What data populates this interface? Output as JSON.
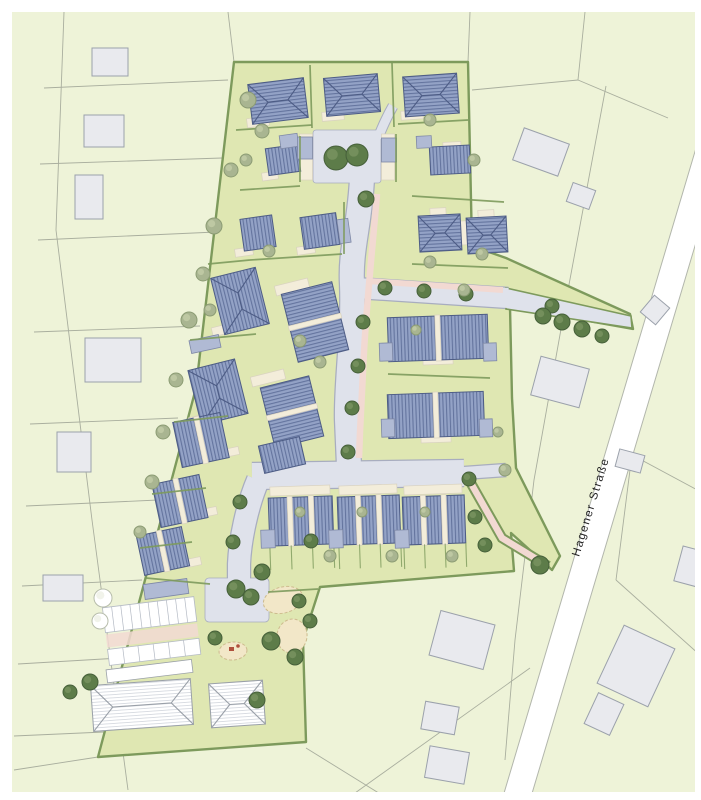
{
  "street_label": "Hagener Straße",
  "palette": {
    "outside": "#eef3d8",
    "parcel": "#a9ae9e",
    "xfill": "#e9eaee",
    "xstroke": "#9ba1ab",
    "site": "#dfe7b2",
    "hedge": "#7d9a5c",
    "road": "#dfe2eb",
    "roadline": "#a8adbf",
    "pink": "#f2d9d2",
    "cream": "#f3edda",
    "creamline": "#d9d2c0",
    "roof": "#93a2c6",
    "roofstripe": "#64749e",
    "roofedge": "#4d5c85",
    "garage": "#b0bad4",
    "sand": "#f2e7c8",
    "equipment": "#b0503c"
  },
  "houses": [
    [
      "hip",
      278,
      101,
      56,
      40,
      -7,
      1
    ],
    [
      "hip",
      352,
      95,
      54,
      38,
      -5,
      1
    ],
    [
      "hip",
      431,
      95,
      54,
      40,
      -4,
      1
    ],
    [
      "gable",
      283,
      160,
      32,
      27,
      -8,
      1
    ],
    [
      "gable",
      258,
      233,
      32,
      32,
      -8,
      1
    ],
    [
      "gable",
      320,
      231,
      36,
      32,
      -8,
      1
    ],
    [
      "hip",
      240,
      301,
      46,
      58,
      -14,
      1
    ],
    [
      "hip",
      218,
      392,
      48,
      56,
      -14,
      1
    ],
    [
      "gable",
      315,
      322,
      52,
      70,
      -14,
      2
    ],
    [
      "gable",
      292,
      412,
      50,
      62,
      -14,
      2
    ],
    [
      "gable",
      282,
      455,
      42,
      28,
      -13,
      1
    ],
    [
      "gable",
      201,
      440,
      48,
      46,
      -12,
      2
    ],
    [
      "gable",
      180,
      501,
      48,
      44,
      -12,
      2
    ],
    [
      "gable",
      163,
      551,
      46,
      40,
      -12,
      2
    ],
    [
      "gable",
      450,
      160,
      40,
      28,
      -3,
      1
    ],
    [
      "hip",
      440,
      233,
      42,
      36,
      -3,
      1
    ],
    [
      "hip",
      487,
      235,
      40,
      36,
      -3,
      1
    ],
    [
      "gable",
      438,
      338,
      100,
      44,
      -2,
      2
    ],
    [
      "gable",
      436,
      415,
      96,
      44,
      -2,
      2
    ],
    [
      "row",
      301,
      521,
      64,
      48,
      -2,
      3
    ],
    [
      "row",
      369,
      520,
      62,
      48,
      -2,
      3
    ],
    [
      "row",
      434,
      520,
      62,
      48,
      -2,
      3
    ],
    [
      "whitehip",
      142,
      705,
      100,
      46,
      -4,
      1
    ],
    [
      "whitehip",
      237,
      704,
      54,
      44,
      -4,
      1
    ]
  ],
  "garages": [
    [
      "garage",
      289,
      141,
      18,
      13,
      -8
    ],
    [
      "garage",
      344,
      231,
      11,
      24,
      -8
    ],
    [
      "garage",
      205,
      344,
      30,
      13,
      -12
    ],
    [
      "garage",
      305,
      148,
      15,
      22,
      0
    ],
    [
      "garage",
      389,
      150,
      15,
      24,
      0
    ],
    [
      "garage",
      424,
      142,
      15,
      12,
      -3
    ],
    [
      "garage",
      386,
      352,
      13,
      18,
      -2
    ],
    [
      "garage",
      490,
      352,
      13,
      18,
      -2
    ],
    [
      "garage",
      388,
      428,
      13,
      18,
      -2
    ],
    [
      "garage",
      486,
      428,
      13,
      18,
      -2
    ],
    [
      "garage",
      268,
      539,
      14,
      18,
      -2
    ],
    [
      "garage",
      336,
      539,
      14,
      18,
      -2
    ],
    [
      "garage",
      402,
      539,
      14,
      18,
      -2
    ],
    [
      "garage",
      166,
      589,
      44,
      15,
      -8
    ]
  ],
  "terraces": [
    [
      258,
      122,
      22,
      9,
      -7
    ],
    [
      333,
      116,
      22,
      9,
      -5
    ],
    [
      412,
      115,
      22,
      9,
      -4
    ],
    [
      270,
      176,
      16,
      8,
      -8
    ],
    [
      244,
      252,
      18,
      8,
      -8
    ],
    [
      306,
      250,
      18,
      8,
      -8
    ],
    [
      222,
      330,
      20,
      9,
      -14
    ],
    [
      199,
      420,
      20,
      9,
      -14
    ],
    [
      292,
      287,
      34,
      10,
      -14
    ],
    [
      268,
      378,
      34,
      10,
      -14
    ],
    [
      231,
      452,
      16,
      8,
      -12
    ],
    [
      209,
      512,
      16,
      8,
      -12
    ],
    [
      194,
      562,
      14,
      8,
      -12
    ],
    [
      452,
      146,
      18,
      8,
      -3
    ],
    [
      438,
      212,
      16,
      8,
      -3
    ],
    [
      462,
      233,
      10,
      24,
      -3
    ],
    [
      486,
      214,
      16,
      8,
      -3
    ],
    [
      404,
      338,
      12,
      26,
      -2
    ],
    [
      472,
      338,
      12,
      26,
      -2
    ],
    [
      404,
      414,
      12,
      26,
      -2
    ],
    [
      470,
      414,
      12,
      26,
      -2
    ],
    [
      438,
      360,
      30,
      9,
      -2
    ],
    [
      436,
      438,
      30,
      9,
      -2
    ],
    [
      306,
      157,
      13,
      46,
      0
    ],
    [
      388,
      157,
      13,
      46,
      0
    ]
  ],
  "trees": {
    "dark": [
      [
        336,
        158,
        12
      ],
      [
        357,
        155,
        11
      ],
      [
        366,
        199,
        8
      ],
      [
        385,
        288,
        7
      ],
      [
        424,
        291,
        7
      ],
      [
        466,
        294,
        7
      ],
      [
        552,
        306,
        7
      ],
      [
        543,
        316,
        8
      ],
      [
        562,
        322,
        8
      ],
      [
        582,
        329,
        8
      ],
      [
        602,
        336,
        7
      ],
      [
        363,
        322,
        7
      ],
      [
        358,
        366,
        7
      ],
      [
        352,
        408,
        7
      ],
      [
        348,
        452,
        7
      ],
      [
        469,
        479,
        7
      ],
      [
        475,
        517,
        7
      ],
      [
        485,
        545,
        7
      ],
      [
        540,
        565,
        9
      ],
      [
        240,
        502,
        7
      ],
      [
        233,
        542,
        7
      ],
      [
        262,
        572,
        8
      ],
      [
        236,
        589,
        9
      ],
      [
        251,
        597,
        8
      ],
      [
        271,
        641,
        9
      ],
      [
        295,
        657,
        8
      ],
      [
        215,
        638,
        7
      ],
      [
        299,
        601,
        7
      ],
      [
        90,
        682,
        8
      ],
      [
        70,
        692,
        7
      ],
      [
        257,
        700,
        8
      ],
      [
        310,
        621,
        7
      ],
      [
        311,
        541,
        7
      ]
    ],
    "light": [
      [
        248,
        100,
        8
      ],
      [
        262,
        131,
        7
      ],
      [
        231,
        170,
        7
      ],
      [
        214,
        226,
        8
      ],
      [
        203,
        274,
        7
      ],
      [
        189,
        320,
        8
      ],
      [
        176,
        380,
        7
      ],
      [
        163,
        432,
        7
      ],
      [
        152,
        482,
        7
      ],
      [
        140,
        532,
        6
      ],
      [
        269,
        251,
        6
      ],
      [
        320,
        362,
        6
      ],
      [
        300,
        341,
        6
      ],
      [
        430,
        262,
        6
      ],
      [
        464,
        290,
        6
      ],
      [
        416,
        330,
        5
      ],
      [
        505,
        470,
        6
      ],
      [
        498,
        432,
        5
      ],
      [
        330,
        556,
        6
      ],
      [
        392,
        556,
        6
      ],
      [
        452,
        556,
        6
      ],
      [
        300,
        512,
        5
      ],
      [
        362,
        512,
        5
      ],
      [
        425,
        512,
        5
      ],
      [
        482,
        254,
        6
      ],
      [
        430,
        120,
        6
      ],
      [
        474,
        160,
        6
      ],
      [
        246,
        160,
        6
      ],
      [
        210,
        310,
        6
      ]
    ],
    "pale": [
      [
        103,
        598,
        9
      ],
      [
        100,
        621,
        8
      ]
    ]
  },
  "existing_buildings": [
    [
      110,
      62,
      36,
      28,
      0
    ],
    [
      104,
      131,
      40,
      32,
      0
    ],
    [
      89,
      197,
      28,
      44,
      0
    ],
    [
      113,
      360,
      56,
      44,
      0
    ],
    [
      74,
      452,
      34,
      40,
      0
    ],
    [
      63,
      588,
      40,
      26,
      0
    ],
    [
      541,
      152,
      48,
      34,
      20
    ],
    [
      581,
      196,
      24,
      20,
      20
    ],
    [
      560,
      382,
      50,
      40,
      15
    ],
    [
      655,
      310,
      20,
      22,
      40
    ],
    [
      630,
      461,
      26,
      18,
      15
    ],
    [
      692,
      567,
      28,
      36,
      15
    ],
    [
      462,
      640,
      56,
      46,
      15
    ],
    [
      440,
      718,
      34,
      28,
      10
    ],
    [
      447,
      765,
      40,
      32,
      10
    ],
    [
      636,
      666,
      56,
      64,
      25
    ],
    [
      604,
      714,
      28,
      34,
      25
    ]
  ],
  "parking": {
    "cx": 152,
    "cy": 634,
    "rot": -7,
    "stalls": 10
  },
  "playground": {
    "sand": [
      [
        283,
        600,
        20,
        13,
        -15
      ],
      [
        292,
        636,
        15,
        17,
        10
      ],
      [
        233,
        651,
        14,
        9,
        -5
      ]
    ]
  }
}
